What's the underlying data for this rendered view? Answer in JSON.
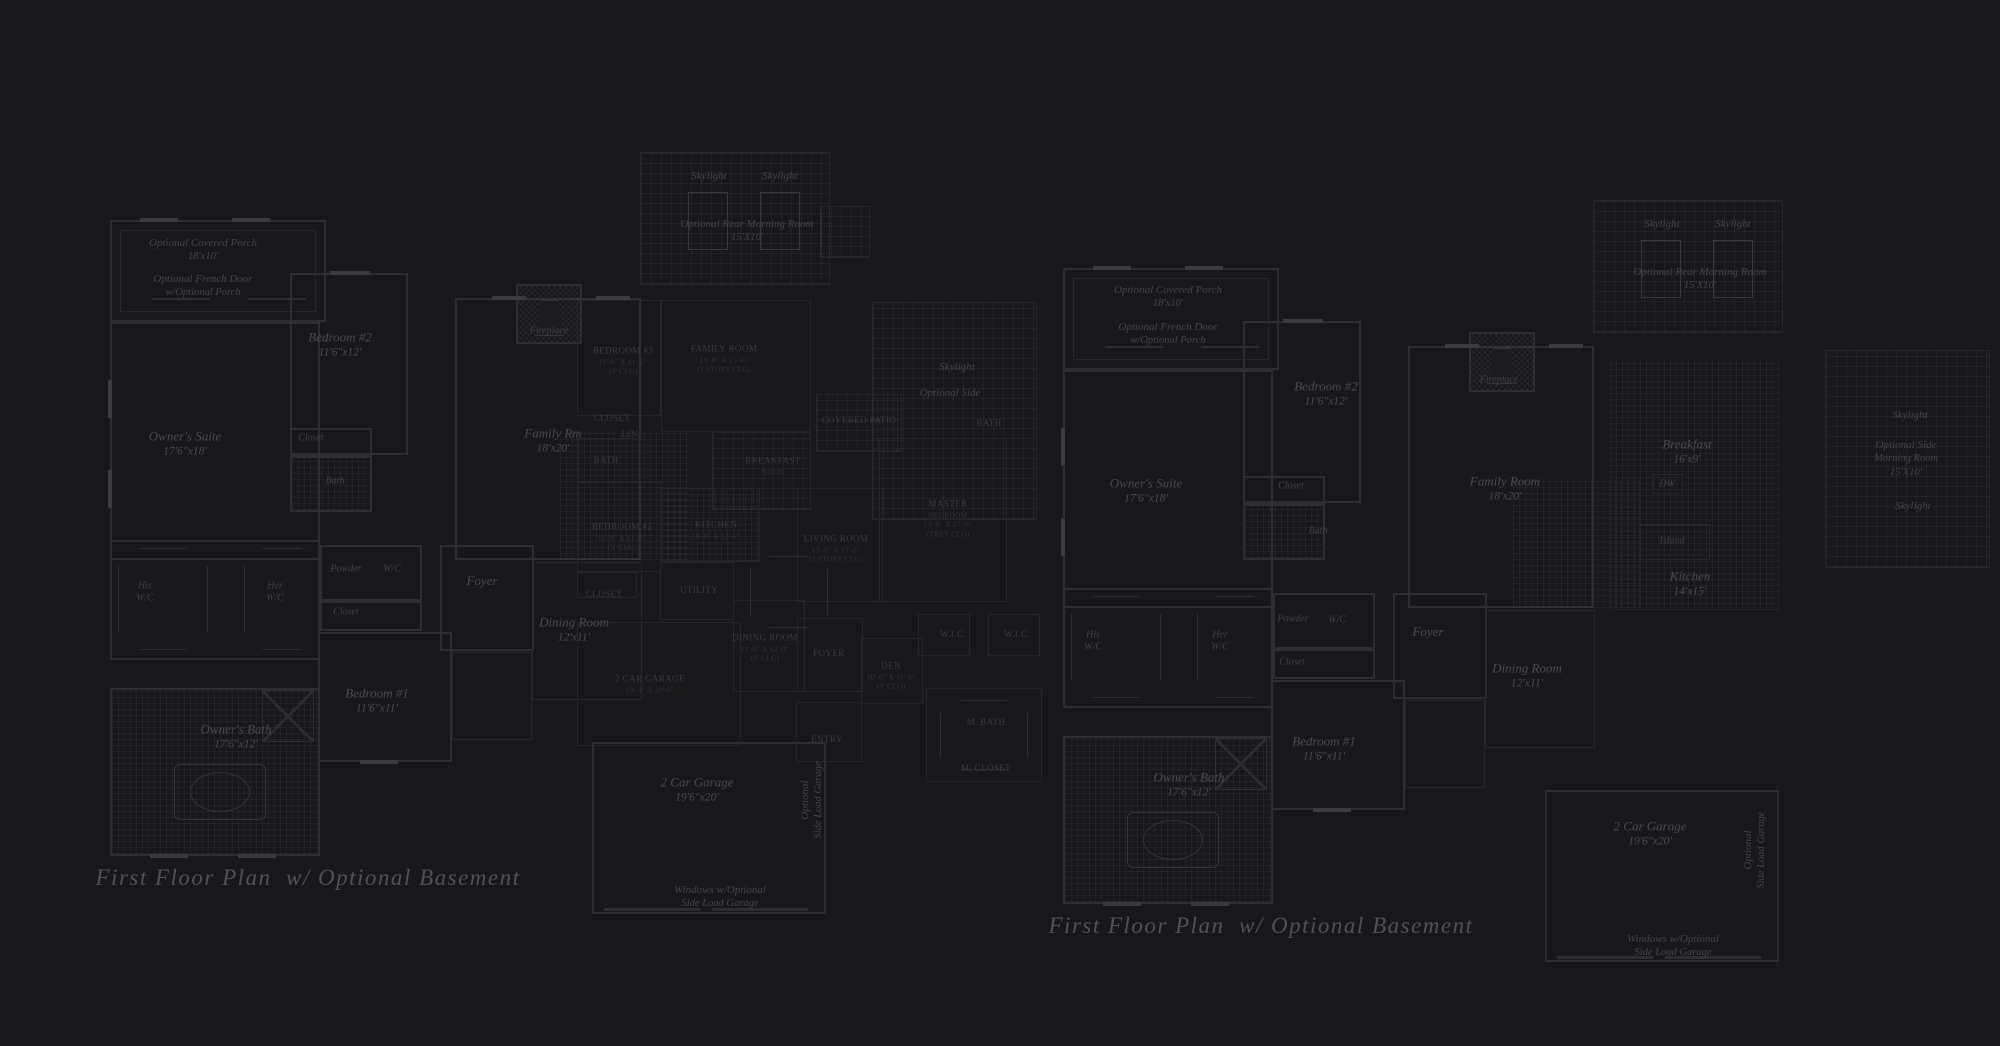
{
  "canvas": {
    "width": 2000,
    "height": 1046,
    "background": "#18181a"
  },
  "colors": {
    "background": "#18181a",
    "wall_line": "#2d2d32",
    "faint_line": "#26262a",
    "label_text": "#4a4a53",
    "caps_text": "#3b3b43",
    "caption_text": "#51515b"
  },
  "plans": [
    {
      "id": "left-floor-plan",
      "style": "italic-serif",
      "caption": {
        "text": "First Floor Plan  w/ Optional Basement",
        "x": 308,
        "y": 878
      },
      "labels": [
        {
          "name": "optional-covered-porch",
          "lines": [
            "Optional Covered Porch",
            "18'x10'"
          ],
          "x": 203,
          "y": 250,
          "cls": "itsm"
        },
        {
          "name": "optional-french-door",
          "lines": [
            "Optional French Door",
            "w/Optional Porch"
          ],
          "x": 203,
          "y": 286,
          "cls": "itsm"
        },
        {
          "name": "bedroom-2",
          "lines": [
            "Bedroom #2",
            "11'6\"x12'"
          ],
          "x": 340,
          "y": 345,
          "cls": "it"
        },
        {
          "name": "owners-suite",
          "lines": [
            "Owner's Suite",
            "17'6\"x18'"
          ],
          "x": 185,
          "y": 444,
          "cls": "it"
        },
        {
          "name": "closet-bedroom2",
          "lines": [
            "Closet"
          ],
          "x": 311,
          "y": 438,
          "cls": "itxs"
        },
        {
          "name": "bath-bedroom2",
          "lines": [
            "Bath"
          ],
          "x": 335,
          "y": 481,
          "cls": "itxs"
        },
        {
          "name": "fireplace",
          "lines": [
            "Fireplace"
          ],
          "x": 549,
          "y": 331,
          "cls": "itxs"
        },
        {
          "name": "family-room",
          "lines": [
            "Family Rm",
            "18'x20'"
          ],
          "x": 553,
          "y": 441,
          "cls": "it"
        },
        {
          "name": "skylight-rear-left",
          "lines": [
            "Skylight"
          ],
          "x": 709,
          "y": 176,
          "cls": "itsm"
        },
        {
          "name": "skylight-rear-right",
          "lines": [
            "Skylight"
          ],
          "x": 780,
          "y": 176,
          "cls": "itsm"
        },
        {
          "name": "optional-rear-morning-room",
          "lines": [
            "Optional Rear Morning Room",
            "15'X10'"
          ],
          "x": 747,
          "y": 231,
          "cls": "itsm"
        },
        {
          "name": "skylight-side",
          "lines": [
            "Skylight"
          ],
          "x": 957,
          "y": 367,
          "cls": "itsm"
        },
        {
          "name": "optional-side-label",
          "lines": [
            "Optional Side"
          ],
          "x": 950,
          "y": 393,
          "cls": "itsm"
        },
        {
          "name": "his-wic",
          "lines": [
            "His",
            "W/C"
          ],
          "x": 145,
          "y": 592,
          "cls": "itxs"
        },
        {
          "name": "her-wic",
          "lines": [
            "Her",
            "W/C"
          ],
          "x": 275,
          "y": 592,
          "cls": "itxs"
        },
        {
          "name": "powder",
          "lines": [
            "Powder"
          ],
          "x": 346,
          "y": 569,
          "cls": "itxs"
        },
        {
          "name": "wic",
          "lines": [
            "W/C"
          ],
          "x": 392,
          "y": 569,
          "cls": "itxs"
        },
        {
          "name": "closet-hall",
          "lines": [
            "Closet"
          ],
          "x": 346,
          "y": 612,
          "cls": "itxs"
        },
        {
          "name": "foyer",
          "lines": [
            "Foyer"
          ],
          "x": 482,
          "y": 581,
          "cls": "it"
        },
        {
          "name": "dining-room",
          "lines": [
            "Dining Room",
            "12'x11'"
          ],
          "x": 574,
          "y": 630,
          "cls": "it"
        },
        {
          "name": "bedroom-1",
          "lines": [
            "Bedroom #1",
            "11'6\"x11'"
          ],
          "x": 377,
          "y": 701,
          "cls": "it"
        },
        {
          "name": "owners-bath",
          "lines": [
            "Owner's Bath",
            "17'6\"x12'"
          ],
          "x": 236,
          "y": 737,
          "cls": "it"
        },
        {
          "name": "garage",
          "lines": [
            "2 Car Garage",
            "19'6\"x20'"
          ],
          "x": 697,
          "y": 790,
          "cls": "it"
        },
        {
          "name": "optional-side-load-garage",
          "lines": [
            "Optional",
            "Side Load Garage"
          ],
          "x": 812,
          "y": 800,
          "cls": "itsm vert"
        },
        {
          "name": "windows-w-optional",
          "lines": [
            "Windows w/Optional",
            "Side Load Garage"
          ],
          "x": 720,
          "y": 897,
          "cls": "itsm"
        }
      ]
    },
    {
      "id": "middle-floor-plan",
      "style": "caps-serif",
      "caption": null,
      "labels": [
        {
          "name": "bedroom-3",
          "lines": [
            "BEDROOM #3",
            "11'-0\" X 11'-6\"",
            "(9' CLG)"
          ],
          "x": 623,
          "y": 361,
          "cls": "caps"
        },
        {
          "name": "family-room",
          "lines": [
            "FAMILY ROOM",
            "19'-0\" X 15'-6\"",
            "(2 STORY CLG)"
          ],
          "x": 724,
          "y": 359,
          "cls": "caps"
        },
        {
          "name": "closet-upper",
          "lines": [
            "CLOSET"
          ],
          "x": 612,
          "y": 419,
          "cls": "caps"
        },
        {
          "name": "linen",
          "lines": [
            "LIN."
          ],
          "x": 631,
          "y": 435,
          "cls": "caps"
        },
        {
          "name": "bath-upper",
          "lines": [
            "BATH"
          ],
          "x": 606,
          "y": 461,
          "cls": "caps"
        },
        {
          "name": "breakfast-nook",
          "lines": [
            "BREAKFAST",
            "NOOK"
          ],
          "x": 773,
          "y": 466,
          "cls": "caps"
        },
        {
          "name": "kitchen",
          "lines": [
            "KITCHEN",
            "10'-0\" X 12'-0\""
          ],
          "x": 716,
          "y": 530,
          "cls": "caps"
        },
        {
          "name": "bedroom-2",
          "lines": [
            "BEDROOM #2",
            "11'-0\" X 11'-0\"",
            "(9' CLG)"
          ],
          "x": 622,
          "y": 537,
          "cls": "caps"
        },
        {
          "name": "living-room",
          "lines": [
            "LIVING ROOM",
            "13'-6\" X 17'-6\"",
            "(2 STORY CLG)"
          ],
          "x": 836,
          "y": 549,
          "cls": "caps"
        },
        {
          "name": "closet-lower",
          "lines": [
            "CLOSET"
          ],
          "x": 604,
          "y": 595,
          "cls": "caps"
        },
        {
          "name": "utility",
          "lines": [
            "UTILITY"
          ],
          "x": 699,
          "y": 591,
          "cls": "caps"
        },
        {
          "name": "dining-room",
          "lines": [
            "DINING ROOM",
            "11'-0\" X 12'-0\"",
            "(9' CLG)"
          ],
          "x": 765,
          "y": 648,
          "cls": "caps"
        },
        {
          "name": "foyer",
          "lines": [
            "FOYER"
          ],
          "x": 829,
          "y": 654,
          "cls": "caps"
        },
        {
          "name": "den",
          "lines": [
            "DEN",
            "10'-0\" X 11'-0\"",
            "(9' CLG)"
          ],
          "x": 891,
          "y": 676,
          "cls": "caps"
        },
        {
          "name": "garage",
          "lines": [
            "2 CAR GARAGE",
            "19'-4\" X 20'-0\""
          ],
          "x": 650,
          "y": 684,
          "cls": "caps"
        },
        {
          "name": "entry",
          "lines": [
            "ENTRY"
          ],
          "x": 827,
          "y": 740,
          "cls": "caps"
        },
        {
          "name": "master-bedroom",
          "lines": [
            "MASTER",
            "BEDROOM",
            "13'-0\" X 17'-0\"",
            "(TREY CLG)"
          ],
          "x": 948,
          "y": 519,
          "cls": "caps"
        },
        {
          "name": "wic-left",
          "lines": [
            "W.I.C."
          ],
          "x": 953,
          "y": 635,
          "cls": "caps"
        },
        {
          "name": "wic-right",
          "lines": [
            "W.I.C."
          ],
          "x": 1017,
          "y": 635,
          "cls": "caps"
        },
        {
          "name": "master-bath",
          "lines": [
            "M. BATH"
          ],
          "x": 986,
          "y": 723,
          "cls": "caps"
        },
        {
          "name": "master-closet",
          "lines": [
            "M. CLOSET"
          ],
          "x": 986,
          "y": 769,
          "cls": "caps"
        },
        {
          "name": "covered-patio",
          "lines": [
            "COVERED PATIO"
          ],
          "x": 859,
          "y": 421,
          "cls": "caps"
        },
        {
          "name": "pool-bath",
          "lines": [
            "BATH"
          ],
          "x": 989,
          "y": 424,
          "cls": "caps"
        }
      ]
    },
    {
      "id": "right-floor-plan",
      "style": "italic-serif",
      "caption": {
        "text": "First Floor Plan  w/ Optional Basement",
        "x": 1261,
        "y": 926
      },
      "labels": [
        {
          "name": "optional-covered-porch",
          "lines": [
            "Optional Covered Porch",
            "18'x10'"
          ],
          "x": 1168,
          "y": 297,
          "cls": "itsm"
        },
        {
          "name": "optional-french-door",
          "lines": [
            "Optional French Door",
            "w/Optional Porch"
          ],
          "x": 1168,
          "y": 334,
          "cls": "itsm"
        },
        {
          "name": "bedroom-2",
          "lines": [
            "Bedroom #2",
            "11'6\"x12'"
          ],
          "x": 1326,
          "y": 394,
          "cls": "it"
        },
        {
          "name": "owners-suite",
          "lines": [
            "Owner's Suite",
            "17'6\"x18'"
          ],
          "x": 1146,
          "y": 491,
          "cls": "it"
        },
        {
          "name": "closet-bedroom2",
          "lines": [
            "Closet"
          ],
          "x": 1291,
          "y": 486,
          "cls": "itxs"
        },
        {
          "name": "bath-bedroom2",
          "lines": [
            "Bath"
          ],
          "x": 1318,
          "y": 531,
          "cls": "itxs"
        },
        {
          "name": "fireplace",
          "lines": [
            "Fireplace"
          ],
          "x": 1499,
          "y": 380,
          "cls": "itxs"
        },
        {
          "name": "family-room",
          "lines": [
            "Family Room",
            "18'x20'"
          ],
          "x": 1505,
          "y": 489,
          "cls": "it"
        },
        {
          "name": "skylight-rear-left",
          "lines": [
            "Skylight"
          ],
          "x": 1662,
          "y": 224,
          "cls": "itsm"
        },
        {
          "name": "skylight-rear-right",
          "lines": [
            "Skylight"
          ],
          "x": 1733,
          "y": 224,
          "cls": "itsm"
        },
        {
          "name": "optional-rear-morning-room",
          "lines": [
            "Optional Rear Morning Room",
            "15'X10'"
          ],
          "x": 1700,
          "y": 279,
          "cls": "itsm"
        },
        {
          "name": "breakfast",
          "lines": [
            "Breakfast",
            "16'x9'"
          ],
          "x": 1687,
          "y": 452,
          "cls": "it"
        },
        {
          "name": "dw",
          "lines": [
            "DW"
          ],
          "x": 1667,
          "y": 484,
          "cls": "itxs"
        },
        {
          "name": "island",
          "lines": [
            "Island"
          ],
          "x": 1672,
          "y": 541,
          "cls": "itxs"
        },
        {
          "name": "kitchen",
          "lines": [
            "Kitchen",
            "14'x15'"
          ],
          "x": 1690,
          "y": 584,
          "cls": "it"
        },
        {
          "name": "skylight-side-top",
          "lines": [
            "Skylight"
          ],
          "x": 1910,
          "y": 415,
          "cls": "itsm"
        },
        {
          "name": "optional-side-morning-room",
          "lines": [
            "Optional Side",
            "Morning Room",
            "15'X10'"
          ],
          "x": 1906,
          "y": 459,
          "cls": "itsm"
        },
        {
          "name": "skylight-side-bottom",
          "lines": [
            "Skylight"
          ],
          "x": 1913,
          "y": 506,
          "cls": "itsm"
        },
        {
          "name": "his-wic",
          "lines": [
            "His",
            "W/C"
          ],
          "x": 1093,
          "y": 641,
          "cls": "itxs"
        },
        {
          "name": "her-wic",
          "lines": [
            "Her",
            "W/C"
          ],
          "x": 1220,
          "y": 641,
          "cls": "itxs"
        },
        {
          "name": "powder",
          "lines": [
            "Powder"
          ],
          "x": 1293,
          "y": 619,
          "cls": "itxs"
        },
        {
          "name": "wic",
          "lines": [
            "W/C"
          ],
          "x": 1337,
          "y": 620,
          "cls": "itxs"
        },
        {
          "name": "closet-hall",
          "lines": [
            "Closet"
          ],
          "x": 1292,
          "y": 662,
          "cls": "itxs"
        },
        {
          "name": "foyer",
          "lines": [
            "Foyer"
          ],
          "x": 1428,
          "y": 632,
          "cls": "it"
        },
        {
          "name": "dining-room",
          "lines": [
            "Dining Room",
            "12'x11'"
          ],
          "x": 1527,
          "y": 676,
          "cls": "it"
        },
        {
          "name": "bedroom-1",
          "lines": [
            "Bedroom #1",
            "11'6\"x11'"
          ],
          "x": 1324,
          "y": 749,
          "cls": "it"
        },
        {
          "name": "owners-bath",
          "lines": [
            "Owner's Bath",
            "17'6\"x12'"
          ],
          "x": 1189,
          "y": 785,
          "cls": "it"
        },
        {
          "name": "garage",
          "lines": [
            "2 Car Garage",
            "19'6\"x20'"
          ],
          "x": 1650,
          "y": 834,
          "cls": "it"
        },
        {
          "name": "optional-side-load-garage",
          "lines": [
            "Optional",
            "Side Load Garage"
          ],
          "x": 1755,
          "y": 850,
          "cls": "itsm vert"
        },
        {
          "name": "windows-w-optional",
          "lines": [
            "Windows w/Optional",
            "Side Load Garage"
          ],
          "x": 1673,
          "y": 946,
          "cls": "itsm"
        }
      ]
    }
  ]
}
